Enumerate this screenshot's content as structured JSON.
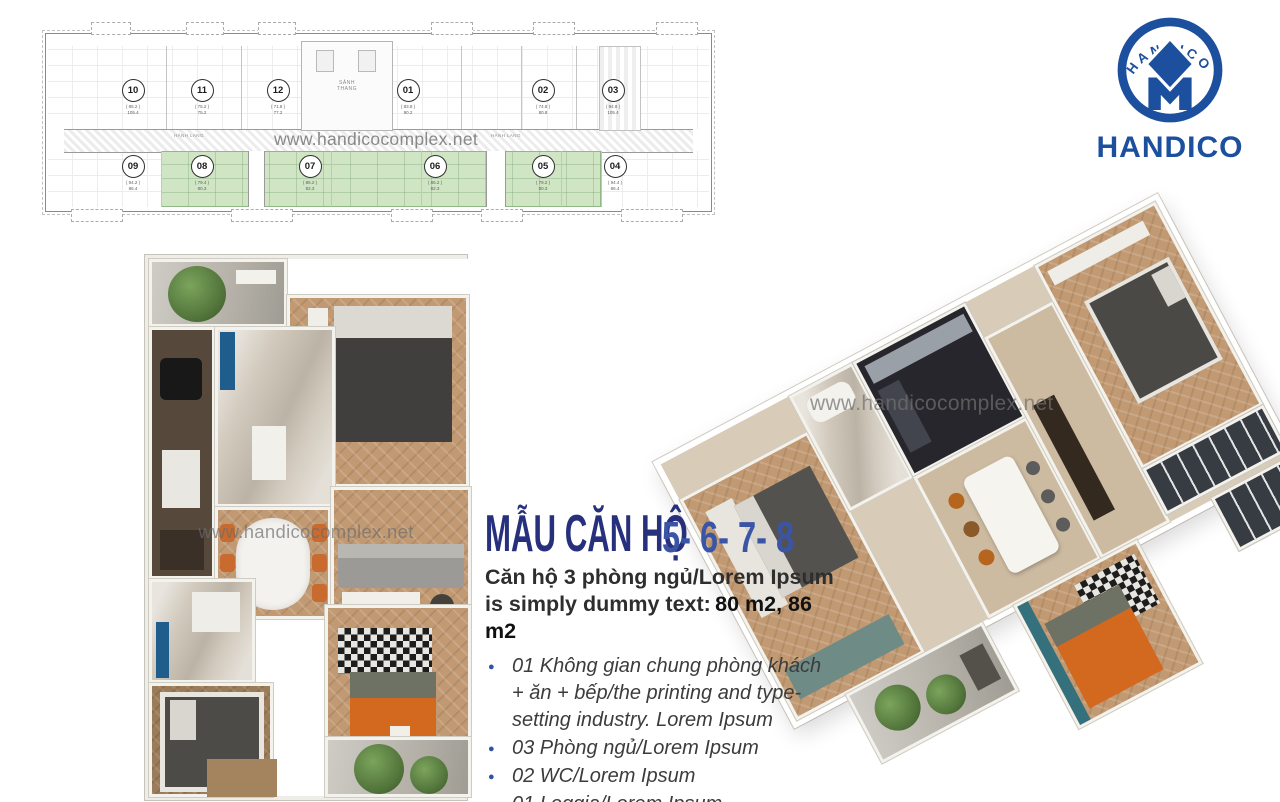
{
  "watermark": {
    "text": "www.handicocomplex.net"
  },
  "logo": {
    "emblem_text": "HANDICO",
    "wordmark": "HANDICO",
    "color": "#1c4f9e"
  },
  "floorplan": {
    "hall_label_left": "HÀNH LANG",
    "hall_label_right": "HÀNH LANG",
    "core_label_line1": "SẢNH",
    "core_label_line2": "THANG",
    "units": [
      {
        "no": "10",
        "gfa": "( 85.2 )",
        "nfa": "105.4"
      },
      {
        "no": "11",
        "gfa": "( 75.2 )",
        "nfa": "75.2"
      },
      {
        "no": "12",
        "gfa": "( 71.8 )",
        "nfa": "77.2"
      },
      {
        "no": "01",
        "gfa": "( 83.8 )",
        "nfa": "90.2"
      },
      {
        "no": "02",
        "gfa": "( 74.8 )",
        "nfa": "80.8"
      },
      {
        "no": "03",
        "gfa": "( 94.8 )",
        "nfa": "105.4"
      },
      {
        "no": "09",
        "gfa": "( 94.2 )",
        "nfa": "86.4"
      },
      {
        "no": "08",
        "gfa": "( 79.4 )",
        "nfa": "80.3"
      },
      {
        "no": "07",
        "gfa": "( 86.2 )",
        "nfa": "82.3"
      },
      {
        "no": "06",
        "gfa": "( 86.2 )",
        "nfa": "82.3"
      },
      {
        "no": "05",
        "gfa": "( 79.2 )",
        "nfa": "80.3"
      },
      {
        "no": "04",
        "gfa": "( 94.4 )",
        "nfa": "86.4"
      }
    ]
  },
  "content": {
    "title": "MẪU CĂN HỘ",
    "title_numbers": "5- 6- 7- 8",
    "subtitle_line1": "Căn hộ 3 phòng ngủ/Lorem Ipsum",
    "subtitle_line2": "is simply dummy text:",
    "subtitle_areas": "80 m2, 86 m2",
    "bullets": [
      "01 Không gian chung phòng khách + ăn + bếp/the printing and type-setting industry. Lorem Ipsum",
      "03 Phòng ngủ/Lorem Ipsum",
      "02 WC/Lorem Ipsum",
      "01 Loggia/Lorem Ipsum"
    ]
  },
  "colors": {
    "title_navy": "#27307c",
    "number_blue": "#3b55a6",
    "logo_blue": "#1c4f9e",
    "highlight_green": "#cfe5c4",
    "accent_orange": "#d2691e"
  }
}
